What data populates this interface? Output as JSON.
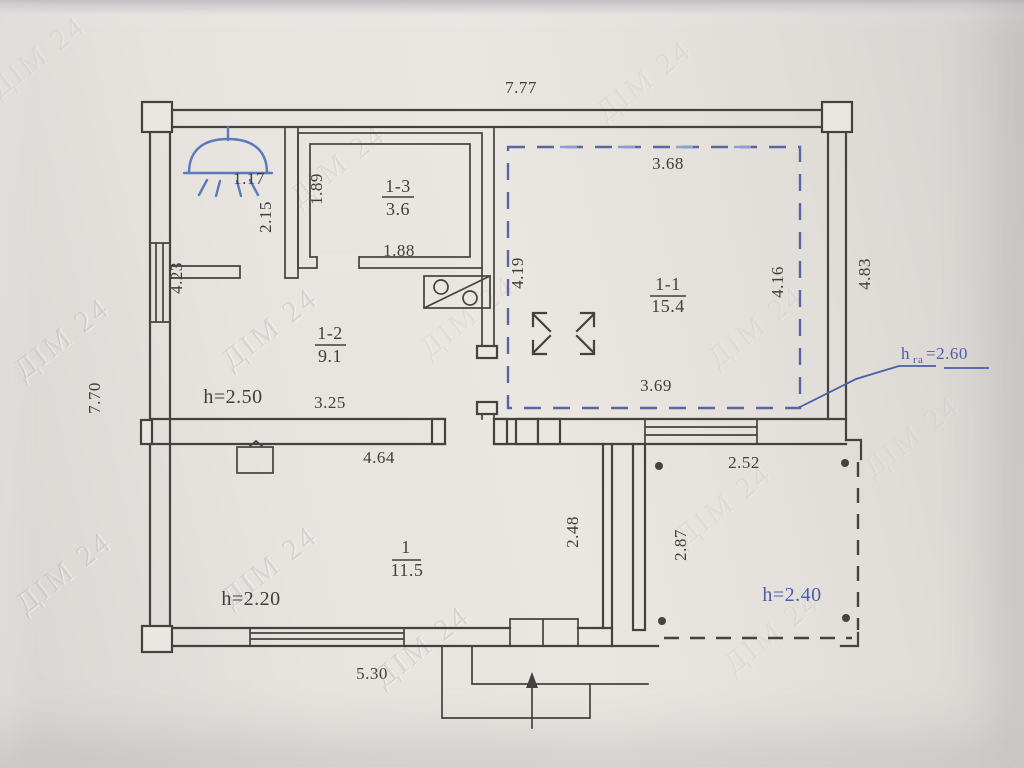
{
  "watermark": {
    "text": "ДІМ 24"
  },
  "colors": {
    "ink": "#44423e",
    "blue_accent": "#4a5ea8",
    "blue_symbol": "#5b79bd",
    "paper": "#e8e4e0"
  },
  "plan": {
    "overall": {
      "top_width": "7.77",
      "left_height": "7.70",
      "right_height": "4.83",
      "bottom_width": "5.30"
    },
    "shower_room": {
      "width": "1.17",
      "height": "2.15",
      "window": "4.23"
    },
    "room_1_3": {
      "number": "1-3",
      "area": "3.6",
      "side": "1.89",
      "bottom": "1.88"
    },
    "room_1_1": {
      "number": "1-1",
      "area": "15.4",
      "top": "3.68",
      "left": "4.19",
      "right": "4.16",
      "bottom": "3.69"
    },
    "room_1_2": {
      "number": "1-2",
      "area": "9.1",
      "ceiling_height": "h=2.50",
      "bottom": "3.25"
    },
    "room_1": {
      "number": "1",
      "area": "11.5",
      "top": "4.64",
      "ceiling_height": "h=2.20",
      "right": "2.48"
    },
    "terrace": {
      "top": "2.52",
      "left": "2.87",
      "ceiling_height": "h=2.40"
    },
    "attic_note": {
      "h": "h",
      "sub": "га",
      "value": "=2.60"
    }
  }
}
